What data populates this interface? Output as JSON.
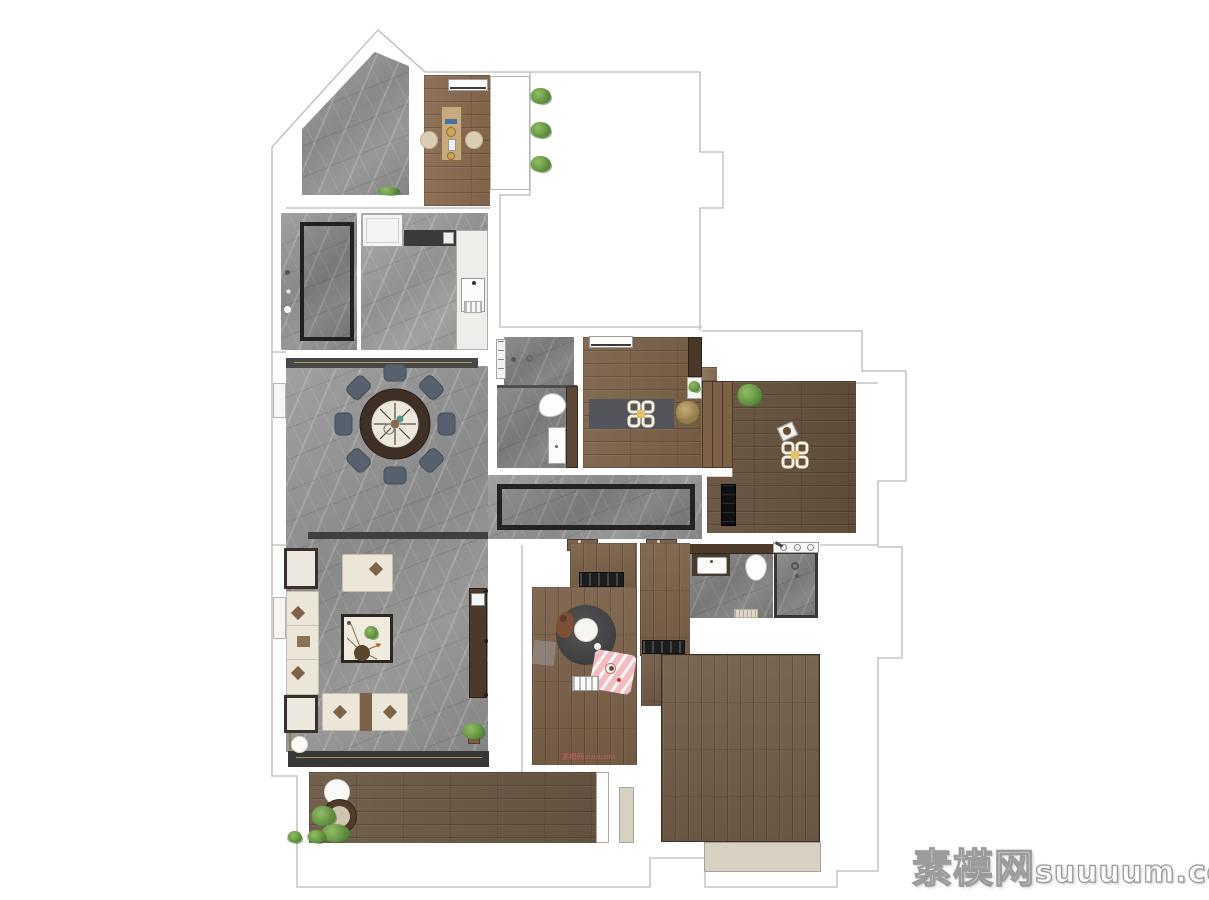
{
  "watermarks": {
    "site_cn": "素模网",
    "site_en": "suuuum.com",
    "inline_small": "素模网suuuum"
  },
  "palette": {
    "background": "#ffffff",
    "marble_floor": "#909090",
    "wood_warm": "#8a6a4e",
    "wood_mid": "#7b6149",
    "wood_dark": "#65513c",
    "wall_dark": "#3a3a3a",
    "outline_gray": "#b9b9b9",
    "accent_gold": "#ab9159",
    "sofa_cream": "#ece6d8",
    "dining_chair_slate": "#57616d",
    "dining_table_brown": "#3e3026",
    "rug_dark": "#474747",
    "plant_green": "#6f9b52",
    "kids_mat_pink": "#f3bcc0",
    "ceiling_lamp_yellow": "#e6c06a",
    "watermark_red": "#e05a66"
  },
  "plan": {
    "type": "residential-floor-plan",
    "rooms": [
      {
        "name": "entry-terrace",
        "floor": "marble"
      },
      {
        "name": "tea-room",
        "floor": "wood",
        "furniture": [
          "tea-table",
          "floor-cushion",
          "floor-cushion",
          "window-sill",
          "planter-plants"
        ]
      },
      {
        "name": "foyer",
        "floor": "marble",
        "furniture": [
          "runner-rug"
        ]
      },
      {
        "name": "kitchen",
        "floor": "marble",
        "furniture": [
          "fridge",
          "cooktop-counter",
          "sink-counter"
        ]
      },
      {
        "name": "dining-area",
        "floor": "marble",
        "furniture": [
          "round-dining-table",
          "eight-chairs"
        ]
      },
      {
        "name": "living-room",
        "floor": "marble",
        "furniture": [
          "corner-sofa-set",
          "coffee-table",
          "side-tables",
          "tv-console",
          "floor-lamp",
          "plant"
        ]
      },
      {
        "name": "shower-bathroom",
        "floor": "marble",
        "furniture": [
          "shower",
          "toilet",
          "vanity",
          "cabinet"
        ]
      },
      {
        "name": "study-room",
        "floor": "wood",
        "furniture": [
          "area-rug",
          "ceiling-light",
          "plant",
          "wardrobe",
          "shelf"
        ]
      },
      {
        "name": "bedroom-right",
        "floor": "wood",
        "furniture": [
          "wardrobe",
          "ceiling-light",
          "plant",
          "ac-unit",
          "chair"
        ]
      },
      {
        "name": "hallway",
        "floor": "marble",
        "furniture": [
          "runner-rug",
          "doors"
        ]
      },
      {
        "name": "kids-room",
        "floor": "wood",
        "furniture": [
          "round-rug",
          "pouf",
          "teddy-bear",
          "play-mat",
          "toy-shelf",
          "wardrobe"
        ]
      },
      {
        "name": "main-bathroom",
        "floor": "marble",
        "furniture": [
          "vanity-sink",
          "toilet",
          "shower",
          "bath-mat",
          "shelf"
        ]
      },
      {
        "name": "bedroom-bottom",
        "floor": "wood",
        "furniture": [
          "closet",
          "bay-window"
        ]
      },
      {
        "name": "balcony",
        "floor": "wood-deck",
        "furniture": [
          "round-table",
          "stool",
          "plants",
          "door-panels"
        ]
      }
    ]
  }
}
